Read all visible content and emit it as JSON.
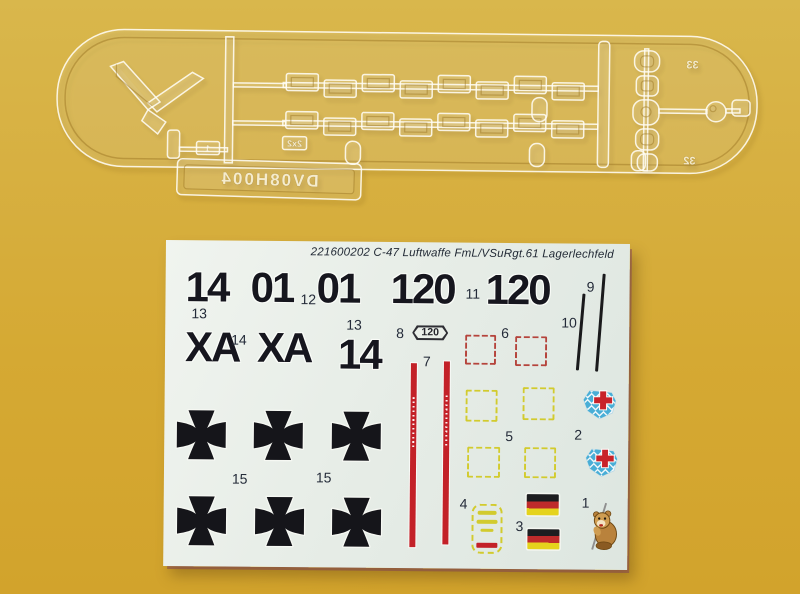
{
  "photo": {
    "subject": "C-47 model kit: clear parts sprue and waterslide decal sheet on gold background",
    "background_color": "#d5a933",
    "sheet_color": "#e7ede7"
  },
  "sprue": {
    "tag": "DV08H004",
    "marks": {
      "canopy": "1",
      "windows": "2x2",
      "top_right": "33",
      "bottom_right": "32"
    }
  },
  "decal": {
    "header": "221600202 C-47 Luftwaffe FmL/VSuRgt.61 Lagerlechfeld",
    "codes": {
      "n14": "14",
      "n01a": "01",
      "n01b": "01",
      "n120a": "120",
      "n120b": "120",
      "xa_a": "XA",
      "xa_b": "XA",
      "n14b": "14"
    },
    "placard": "120",
    "refs": {
      "r1": "1",
      "r2": "2",
      "r3": "3",
      "r4": "4",
      "r5": "5",
      "r6": "6",
      "r7": "7",
      "r8": "8",
      "r9": "9",
      "r10": "10",
      "r11": "11",
      "r12": "12",
      "r13a": "13",
      "r13b": "13",
      "r14": "14",
      "r15a": "15",
      "r15b": "15"
    },
    "colors": {
      "cross": "#15151a",
      "stripe_red": "#c32128",
      "dash_yellow": "#d2cb2e",
      "dash_red": "#b5443c",
      "flag_black": "#1d1d20",
      "flag_red": "#bf2b2b",
      "flag_gold": "#e5d31d",
      "crest_blue": "#49aed6",
      "crest_red": "#c8232a"
    }
  }
}
